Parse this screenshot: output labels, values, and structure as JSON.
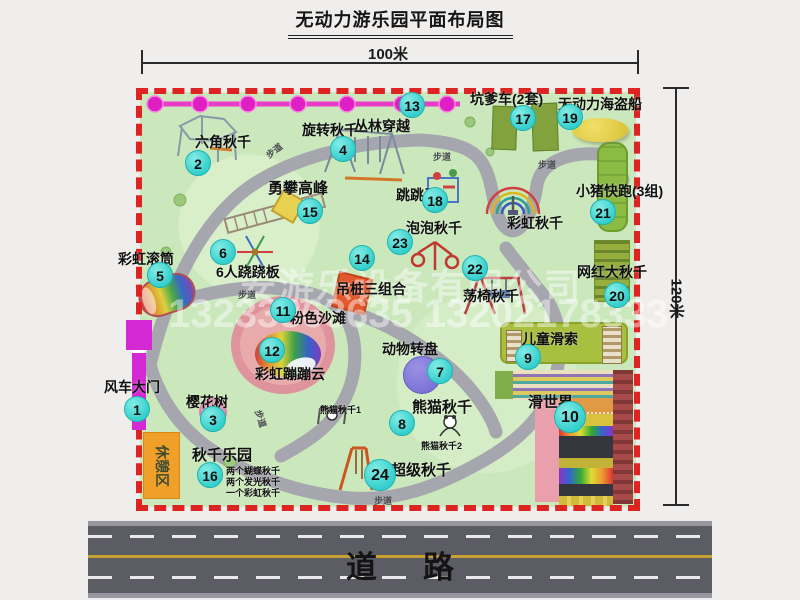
{
  "title": "无动力游乐园平面布局图",
  "dimensions": {
    "width": "100米",
    "height": "120米"
  },
  "road_label": "道路",
  "trail_label": "步道",
  "watermark": {
    "company": "安游乐设备有限公司",
    "phone": "13233863635 13202178333"
  },
  "unnumbered": {
    "rainbow_swing": "彩虹秋千",
    "rest_area": "休憩区"
  },
  "features": [
    {
      "num": "1",
      "label": "风车大门"
    },
    {
      "num": "2",
      "label": "六角秋千"
    },
    {
      "num": "3",
      "label": "樱花树"
    },
    {
      "num": "4",
      "label": "旋转秋千"
    },
    {
      "num": "5",
      "label": "彩虹滚筒"
    },
    {
      "num": "6",
      "label": "6人跷跷板"
    },
    {
      "num": "7",
      "label": "动物转盘"
    },
    {
      "num": "8",
      "label": "熊猫秋千",
      "sub1": "熊猫秋千1",
      "sub2": "熊猫秋千2"
    },
    {
      "num": "9",
      "label": "儿童滑索"
    },
    {
      "num": "10",
      "label": "滑世界"
    },
    {
      "num": "11",
      "label": "粉色沙滩"
    },
    {
      "num": "12",
      "label": "彩虹蹦蹦云"
    },
    {
      "num": "13",
      "label": "丛林穿越"
    },
    {
      "num": "14",
      "label": "吊桩三组合"
    },
    {
      "num": "15",
      "label": "勇攀高峰"
    },
    {
      "num": "16",
      "label": "秋千乐园",
      "notes": [
        "两个蝴蝶秋千",
        "两个发光秋千",
        "一个彩虹秋千"
      ]
    },
    {
      "num": "17",
      "label": "坑爹车(2套)"
    },
    {
      "num": "18",
      "label": "跳跳马"
    },
    {
      "num": "19",
      "label": "无动力海盗船"
    },
    {
      "num": "20",
      "label": "网红大秋千"
    },
    {
      "num": "21",
      "label": "小猪快跑(3组)"
    },
    {
      "num": "22",
      "label": "荡椅秋千"
    },
    {
      "num": "23",
      "label": "泡泡秋千"
    },
    {
      "num": "24",
      "label": "超级秋千"
    }
  ],
  "colors": {
    "border_red": "#de2323",
    "park_green": "#cbe8bc",
    "path_gray": "#a6a6ae",
    "badge_cyan": "#35cfcc",
    "gate_magenta": "#d428d4",
    "trail_pink": "#e83cc8",
    "rest_orange": "#f0a028",
    "road_gray": "#5c5c65",
    "road_yellow": "#c7a233"
  }
}
